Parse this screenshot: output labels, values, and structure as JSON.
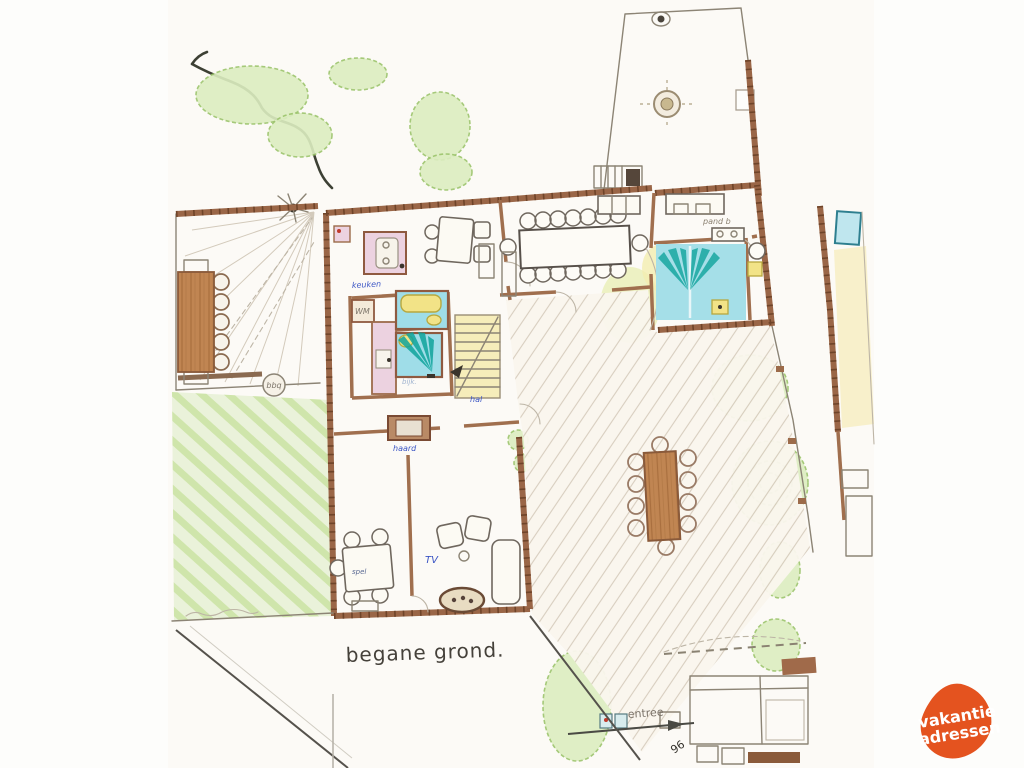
{
  "plan": {
    "title": "begane grond.",
    "rooms": {
      "keuken": "keuken",
      "hal": "hal",
      "bijkeuken": "bijk.",
      "bedroom_label": "pand b"
    },
    "items": {
      "wm": "WM",
      "haard": "haard",
      "tv": "TV",
      "spel": "spel",
      "bbq": "bbq"
    },
    "entrance": {
      "entree": "entree",
      "number": "96"
    }
  },
  "logo": {
    "line1": "vakantie",
    "line2": "adressen",
    "bg_color": "#e4531f",
    "text_color": "#ffffff"
  },
  "colors": {
    "wall_brown": "#9a6647",
    "bath_blue": "#9fdde8",
    "spray_teal": "#0fa39b",
    "room_pink": "#ecd2e0",
    "fixture_yellow": "#f2e387",
    "wood": "#c08552",
    "garden_green": "#9cc46c",
    "pencil_gray": "#8c8475",
    "ink_blue": "#3b55c4"
  }
}
